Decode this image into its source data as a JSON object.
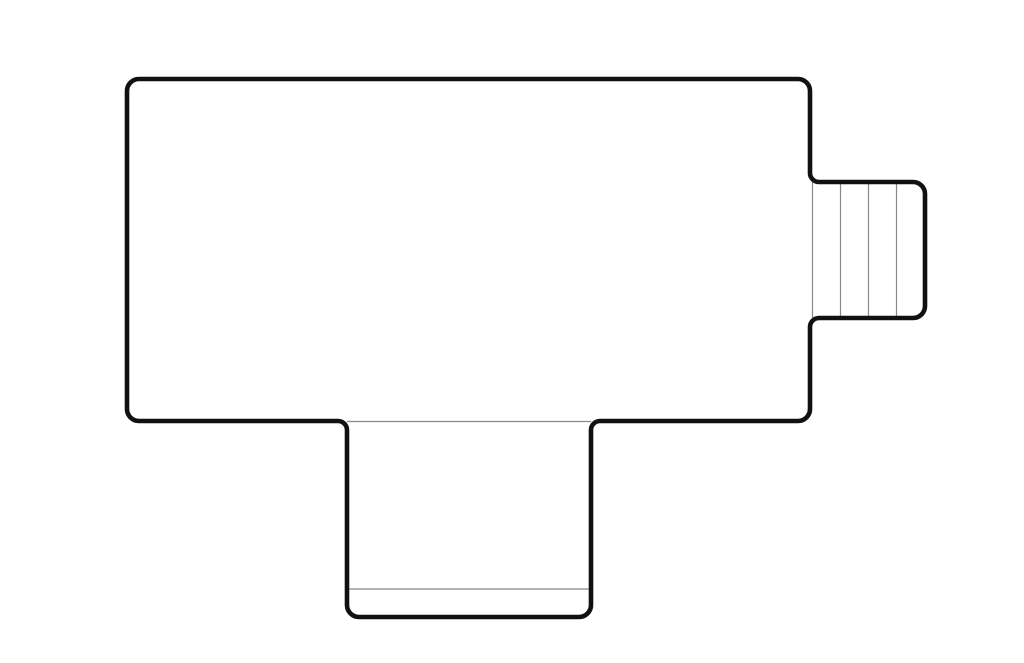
{
  "canvas": {
    "width": 1024,
    "height": 663,
    "background": "#ffffff"
  },
  "plan": {
    "outline": {
      "stroke_color": "#111111",
      "stroke_width": 4.6,
      "fill_color": "#ffffff",
      "corner_radius": 12,
      "junction_fillet_radius": 9,
      "main_room": {
        "left": 127,
        "top": 79,
        "right": 810,
        "bottom": 421
      },
      "right_wing_stairs": {
        "left": 810,
        "top": 182,
        "right": 925,
        "bottom": 318
      },
      "bottom_wing_porch": {
        "left": 347,
        "top": 421,
        "right": 591,
        "bottom": 617
      }
    },
    "thin_lines": {
      "color": "#888888",
      "width": 1.2,
      "stairs_tread_lines_x": [
        812.5,
        840.5,
        868.5,
        896.5
      ],
      "stairs_y_span": [
        182,
        318
      ],
      "porch_lines_y": [
        421.5,
        589
      ],
      "porch_x_span": [
        347,
        591
      ]
    }
  }
}
